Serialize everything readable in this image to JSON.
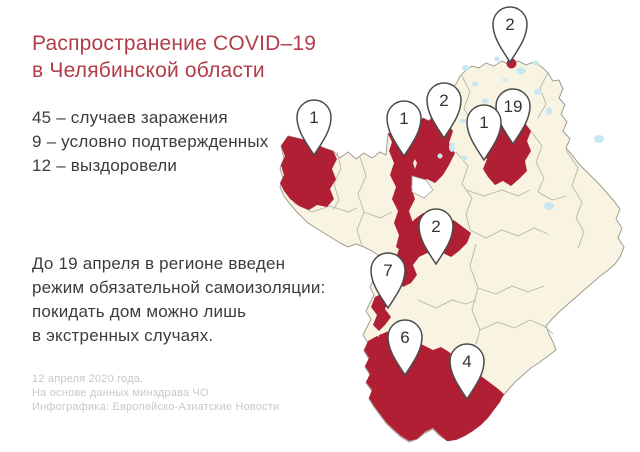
{
  "header": {
    "title_line1": "Распространение COVID–19",
    "title_line2": "в Челябинской области"
  },
  "stats": {
    "lines": [
      "45 – случаев заражения",
      "9 – условно подтвержденных",
      "12 – выздоровели"
    ]
  },
  "restriction": {
    "lines": [
      "До 19 апреля в регионе введен",
      "режим обязательной самоизоляции:",
      "покидать дом можно лишь",
      "в экстренных случаях."
    ]
  },
  "footer": {
    "lines": [
      "12 апреля 2020 года.",
      "На основе данных минздрава ЧО",
      "Инфографика: Европейско-Азиатские Новости"
    ]
  },
  "colors": {
    "title_red": "#b23c48",
    "infected_red": "#b01f33",
    "map_fill": "#f8f4e1",
    "lake_blue": "#c9e6f3",
    "border_gray": "#9d9d95",
    "footer_gray": "#c8c8c8",
    "text_dark": "#3c3c3c"
  },
  "map": {
    "pins": [
      {
        "value": "2",
        "x": 510,
        "y": 24,
        "dot": true
      },
      {
        "value": "19",
        "x": 513,
        "y": 106
      },
      {
        "value": "1",
        "x": 484,
        "y": 122
      },
      {
        "value": "2",
        "x": 444,
        "y": 100
      },
      {
        "value": "1",
        "x": 404,
        "y": 118
      },
      {
        "value": "1",
        "x": 314,
        "y": 117
      },
      {
        "value": "2",
        "x": 436,
        "y": 226
      },
      {
        "value": "7",
        "x": 388,
        "y": 270
      },
      {
        "value": "6",
        "x": 405,
        "y": 337
      },
      {
        "value": "4",
        "x": 467,
        "y": 361
      }
    ]
  }
}
